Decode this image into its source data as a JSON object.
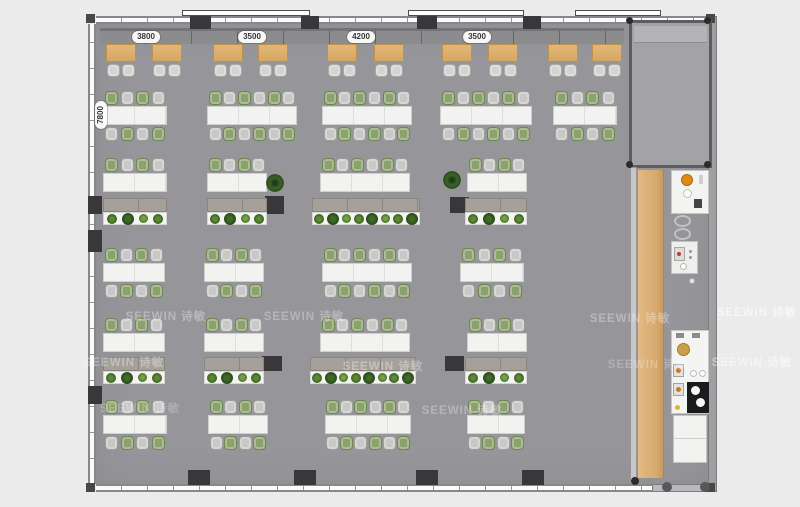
{
  "title": "office floor plan",
  "colors": {
    "background": "#ebebeb",
    "floor": "#96969a",
    "wall": "#88888a",
    "column": "#38383b",
    "booth_table": "#d9ab67",
    "desk": "#f2f2f0",
    "chair_green": "#8ca26e",
    "chair_gray": "#c8c8c6",
    "wood_strip": "#d7aa6f",
    "plant": "#3c6326",
    "accent_orange": "#e08a12"
  },
  "watermark": {
    "brand": "SEEWIN",
    "cn": "诗敏"
  },
  "watermarks": [
    {
      "x": 166,
      "y": 316,
      "o": 0.32
    },
    {
      "x": 304,
      "y": 316,
      "o": 0.3
    },
    {
      "x": 630,
      "y": 318,
      "o": 0.32
    },
    {
      "x": 124,
      "y": 362,
      "o": 0.32
    },
    {
      "x": 383,
      "y": 366,
      "o": 0.34
    },
    {
      "x": 648,
      "y": 364,
      "o": 0.25
    },
    {
      "x": 140,
      "y": 408,
      "o": 0.22
    },
    {
      "x": 462,
      "y": 410,
      "o": 0.3
    },
    {
      "x": 757,
      "y": 312,
      "o": 0.55
    },
    {
      "x": 752,
      "y": 362,
      "o": 0.45
    }
  ],
  "dimensions": {
    "top": [
      {
        "text": "3800",
        "cx": 146
      },
      {
        "text": "3500",
        "cx": 252
      },
      {
        "text": "4200",
        "cx": 361
      },
      {
        "text": "3500",
        "cx": 477
      }
    ],
    "top_cy": 31,
    "left": {
      "text": "7800",
      "cx": 101,
      "cy": 115
    }
  },
  "structure": {
    "sills": [
      {
        "x": 182,
        "y": 10,
        "w": 128,
        "h": 6
      },
      {
        "x": 408,
        "y": 10,
        "w": 116,
        "h": 6
      },
      {
        "x": 575,
        "y": 10,
        "w": 86,
        "h": 6
      }
    ],
    "columns": [
      {
        "x": 190,
        "y": 16,
        "w": 21,
        "h": 13
      },
      {
        "x": 301,
        "y": 16,
        "w": 18,
        "h": 13
      },
      {
        "x": 417,
        "y": 16,
        "w": 20,
        "h": 13
      },
      {
        "x": 523,
        "y": 16,
        "w": 18,
        "h": 13
      },
      {
        "x": 188,
        "y": 470,
        "w": 22,
        "h": 15
      },
      {
        "x": 294,
        "y": 470,
        "w": 22,
        "h": 15
      },
      {
        "x": 416,
        "y": 470,
        "w": 22,
        "h": 15
      },
      {
        "x": 522,
        "y": 470,
        "w": 22,
        "h": 15
      },
      {
        "x": 88,
        "y": 196,
        "w": 14,
        "h": 18
      },
      {
        "x": 88,
        "y": 230,
        "w": 14,
        "h": 22
      },
      {
        "x": 88,
        "y": 386,
        "w": 14,
        "h": 18
      },
      {
        "x": 265,
        "y": 196,
        "w": 19,
        "h": 18
      },
      {
        "x": 450,
        "y": 197,
        "w": 19,
        "h": 16
      },
      {
        "x": 262,
        "y": 356,
        "w": 20,
        "h": 15
      },
      {
        "x": 445,
        "y": 356,
        "w": 19,
        "h": 15
      }
    ],
    "dots": [
      {
        "x": 626,
        "y": 17,
        "d": 7
      },
      {
        "x": 704,
        "y": 17,
        "d": 7
      },
      {
        "x": 626,
        "y": 161,
        "d": 7
      },
      {
        "x": 704,
        "y": 161,
        "d": 7
      },
      {
        "x": 631,
        "y": 477,
        "d": 8
      }
    ]
  },
  "furniture": {
    "booths": {
      "y": 44,
      "w": 30,
      "h": 18,
      "xs": [
        106,
        152,
        213,
        258,
        327,
        374,
        442,
        488,
        548,
        592
      ]
    },
    "desk_rows": [
      {
        "y": 106,
        "double": true,
        "clusters": [
          {
            "x": 103,
            "w": 64,
            "s": 4
          },
          {
            "x": 207,
            "w": 90,
            "s": 6
          },
          {
            "x": 322,
            "w": 90,
            "s": 6
          },
          {
            "x": 440,
            "w": 92,
            "s": 6
          },
          {
            "x": 553,
            "w": 64,
            "s": 4
          }
        ]
      },
      {
        "y": 173,
        "double": false,
        "clusters": [
          {
            "x": 103,
            "w": 64,
            "s": 4
          },
          {
            "x": 207,
            "w": 60,
            "s": 4
          },
          {
            "x": 320,
            "w": 90,
            "s": 6
          },
          {
            "x": 467,
            "w": 60,
            "s": 4
          }
        ]
      },
      {
        "y": 263,
        "double": true,
        "clusters": [
          {
            "x": 103,
            "w": 62,
            "s": 4
          },
          {
            "x": 204,
            "w": 60,
            "s": 4
          },
          {
            "x": 322,
            "w": 90,
            "s": 6
          },
          {
            "x": 460,
            "w": 64,
            "s": 4
          }
        ]
      },
      {
        "y": 333,
        "double": false,
        "clusters": [
          {
            "x": 103,
            "w": 62,
            "s": 4
          },
          {
            "x": 204,
            "w": 60,
            "s": 4
          },
          {
            "x": 320,
            "w": 90,
            "s": 6
          },
          {
            "x": 467,
            "w": 60,
            "s": 4
          }
        ]
      },
      {
        "y": 415,
        "double": true,
        "clusters": [
          {
            "x": 103,
            "w": 64,
            "s": 4
          },
          {
            "x": 208,
            "w": 60,
            "s": 4
          },
          {
            "x": 325,
            "w": 86,
            "s": 6
          },
          {
            "x": 467,
            "w": 58,
            "s": 4
          }
        ]
      }
    ],
    "planter_rows": [
      {
        "y": 198,
        "units": [
          {
            "x": 103,
            "w": 64,
            "p": 4
          },
          {
            "x": 207,
            "w": 60,
            "p": 4
          },
          {
            "x": 312,
            "w": 108,
            "p": 8
          },
          {
            "x": 465,
            "w": 62,
            "p": 4
          }
        ]
      },
      {
        "y": 357,
        "units": [
          {
            "x": 103,
            "w": 62,
            "p": 4
          },
          {
            "x": 204,
            "w": 60,
            "p": 4
          },
          {
            "x": 310,
            "w": 106,
            "p": 8
          },
          {
            "x": 465,
            "w": 62,
            "p": 4
          }
        ]
      }
    ],
    "floor_plants": [
      {
        "x": 266,
        "y": 174
      },
      {
        "x": 443,
        "y": 171
      }
    ]
  },
  "pantry": {
    "shapes": [
      {
        "n": "pantry-counter-top",
        "t": "rect",
        "x": 671,
        "y": 170,
        "w": 38,
        "h": 44,
        "f": "#f3f3f1",
        "s": "#c7c7c5"
      },
      {
        "n": "orange-bowl",
        "t": "circ",
        "x": 681,
        "y": 174,
        "d": 12,
        "f": "#e08a12",
        "s": "#a96a08"
      },
      {
        "n": "dish",
        "t": "circ",
        "x": 683,
        "y": 189,
        "d": 9,
        "f": "#fbfbf9",
        "s": "#c0c0be"
      },
      {
        "n": "small-item",
        "t": "rect",
        "x": 699,
        "y": 175,
        "w": 4,
        "h": 9,
        "f": "#cfcfcd"
      },
      {
        "n": "speaker",
        "t": "rect",
        "x": 694,
        "y": 199,
        "w": 8,
        "h": 9,
        "f": "#454547"
      },
      {
        "n": "stool",
        "t": "ring",
        "x": 674,
        "y": 215,
        "w": 17,
        "h": 12,
        "s": "#c2c2c0"
      },
      {
        "n": "stool",
        "t": "ring",
        "x": 674,
        "y": 228,
        "w": 17,
        "h": 12,
        "s": "#c2c2c0"
      },
      {
        "n": "appliance-cart",
        "t": "rect",
        "x": 671,
        "y": 241,
        "w": 27,
        "h": 33,
        "f": "#eeeeec",
        "s": "#c3c3c1"
      },
      {
        "n": "machine",
        "t": "rect",
        "x": 674,
        "y": 247,
        "w": 11,
        "h": 14,
        "f": "#dcdcda",
        "s": "#a7a7a5"
      },
      {
        "n": "red-dot",
        "t": "circ",
        "x": 677,
        "y": 252,
        "d": 4,
        "f": "#c23a28"
      },
      {
        "n": "knob",
        "t": "circ",
        "x": 689,
        "y": 250,
        "d": 3,
        "f": "#98989a"
      },
      {
        "n": "knob",
        "t": "circ",
        "x": 689,
        "y": 256,
        "d": 3,
        "f": "#98989a"
      },
      {
        "n": "cup",
        "t": "circ",
        "x": 680,
        "y": 263,
        "d": 7,
        "f": "#fbfbf9",
        "s": "#b8b8b6"
      },
      {
        "n": "small-circle",
        "t": "circ",
        "x": 689,
        "y": 278,
        "d": 6,
        "f": "#e4e4e2",
        "s": "#aeaeac"
      },
      {
        "n": "pantry-counter-bottom",
        "t": "rect",
        "x": 671,
        "y": 330,
        "w": 38,
        "h": 84,
        "f": "#f4f4f2",
        "s": "#c7c7c5"
      },
      {
        "n": "handle",
        "t": "rect",
        "x": 676,
        "y": 333,
        "w": 8,
        "h": 5,
        "f": "#8c8c8e"
      },
      {
        "n": "handle",
        "t": "rect",
        "x": 692,
        "y": 333,
        "w": 8,
        "h": 5,
        "f": "#8c8c8e"
      },
      {
        "n": "gold-sink",
        "t": "circ",
        "x": 677,
        "y": 343,
        "d": 13,
        "f": "#caa14a",
        "s": "#a37d2c"
      },
      {
        "n": "burner-unit",
        "t": "rect",
        "x": 673,
        "y": 364,
        "w": 11,
        "h": 13,
        "f": "#e2e2e0",
        "s": "#a3a3a1"
      },
      {
        "n": "flame-dot",
        "t": "circ",
        "x": 676,
        "y": 368,
        "d": 5,
        "f": "#cd7a1c"
      },
      {
        "n": "burner-unit",
        "t": "rect",
        "x": 673,
        "y": 383,
        "w": 11,
        "h": 13,
        "f": "#e2e2e0",
        "s": "#a3a3a1"
      },
      {
        "n": "flame-dot",
        "t": "circ",
        "x": 676,
        "y": 387,
        "d": 5,
        "f": "#cd7a1c"
      },
      {
        "n": "cup",
        "t": "circ",
        "x": 690,
        "y": 370,
        "d": 7,
        "f": "#fdfdfb",
        "s": "#bbbbb9"
      },
      {
        "n": "cup",
        "t": "circ",
        "x": 699,
        "y": 370,
        "d": 7,
        "f": "#fdfdfb",
        "s": "#bbbbb9"
      },
      {
        "n": "cooktop",
        "t": "rect",
        "x": 687,
        "y": 382,
        "w": 22,
        "h": 31,
        "f": "#1b1b1d"
      },
      {
        "n": "pot",
        "t": "circ",
        "x": 691,
        "y": 386,
        "d": 9,
        "f": "#f6f6f4"
      },
      {
        "n": "pot",
        "t": "circ",
        "x": 696,
        "y": 398,
        "d": 9,
        "f": "#f6f6f4"
      },
      {
        "n": "yellow-dot",
        "t": "circ",
        "x": 675,
        "y": 405,
        "d": 5,
        "f": "#ddb62a"
      },
      {
        "n": "white-cabinet",
        "t": "rect",
        "x": 673,
        "y": 415,
        "w": 34,
        "h": 48,
        "f": "#f2f2f0",
        "s": "#c5c5c3"
      },
      {
        "n": "cabinet-seam",
        "t": "rect",
        "x": 673,
        "y": 438,
        "w": 34,
        "h": 1,
        "f": "#cfcfcd"
      },
      {
        "n": "round-column",
        "t": "circ",
        "x": 662,
        "y": 482,
        "d": 10,
        "f": "#58585a"
      },
      {
        "n": "round-column",
        "t": "circ",
        "x": 700,
        "y": 482,
        "d": 10,
        "f": "#58585a"
      }
    ]
  }
}
